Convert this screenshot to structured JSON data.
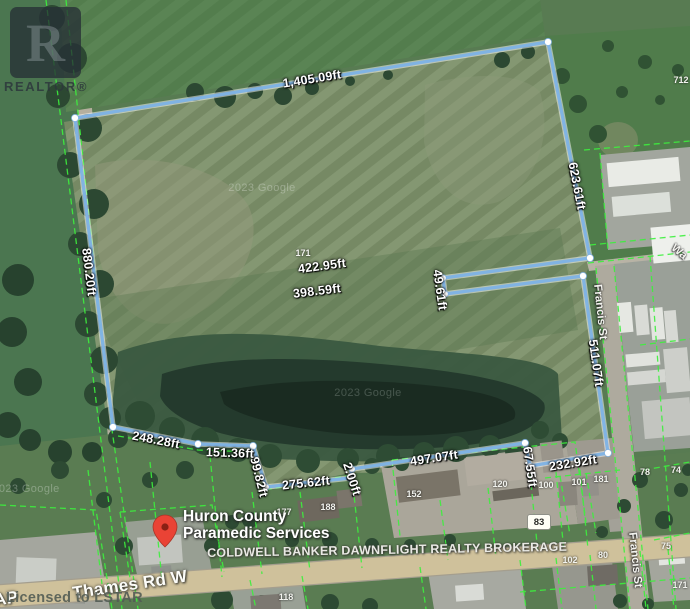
{
  "branding": {
    "realtor_letter": "R",
    "realtor_label": "REALTOR®",
    "license": "Licensed to LSTAR"
  },
  "watermarks": {
    "google_top": "2023 Google",
    "google_pond": "2023 Google",
    "google_left": "2023 Google"
  },
  "measurements": {
    "top": "1,405.09ft",
    "east": "623.61ft",
    "west": "880.20ft",
    "notch_upper": "422.95ft",
    "notch_lower": "398.59ft",
    "notch_end": "49.61ft",
    "southeast": "511.07ft",
    "south_east_end": "232.92ft",
    "south_step": "67.55ft",
    "south_long": "497.07ft",
    "south_jog": "2.00ft",
    "south_mid": "275.62ft",
    "west_step": "99.82ft",
    "south_small": "151.36ft",
    "southwest": "248.28ft"
  },
  "streets": {
    "thames": "Thames Rd W",
    "thames_partial": "AP",
    "francis_upper": "Francis St",
    "francis_lower": "Francis St",
    "east_road_partial": "Wa"
  },
  "poi": {
    "name_line1": "Huron County",
    "name_line2": "Paramedic Services"
  },
  "overlay_text": {
    "brokerage": "COLDWELL BANKER DAWNFLIGHT REALTY BROKERAGE"
  },
  "road_shield": {
    "number": "83"
  },
  "lot_numbers": {
    "field": "171",
    "ne": "712",
    "r1": "177",
    "r2": "188",
    "r3": "152",
    "r4": "120",
    "r5": "100",
    "r6": "101",
    "r7": "181",
    "r8": "78",
    "r9": "74",
    "r10": "102",
    "r11": "80",
    "r12": "75",
    "r13": "171",
    "r14": "118"
  },
  "colors": {
    "boundary_line": "#7db2e6",
    "parcel_line": "#3df03d",
    "poi_pin": "#ea4335",
    "road_fill": "#cfc19b"
  }
}
